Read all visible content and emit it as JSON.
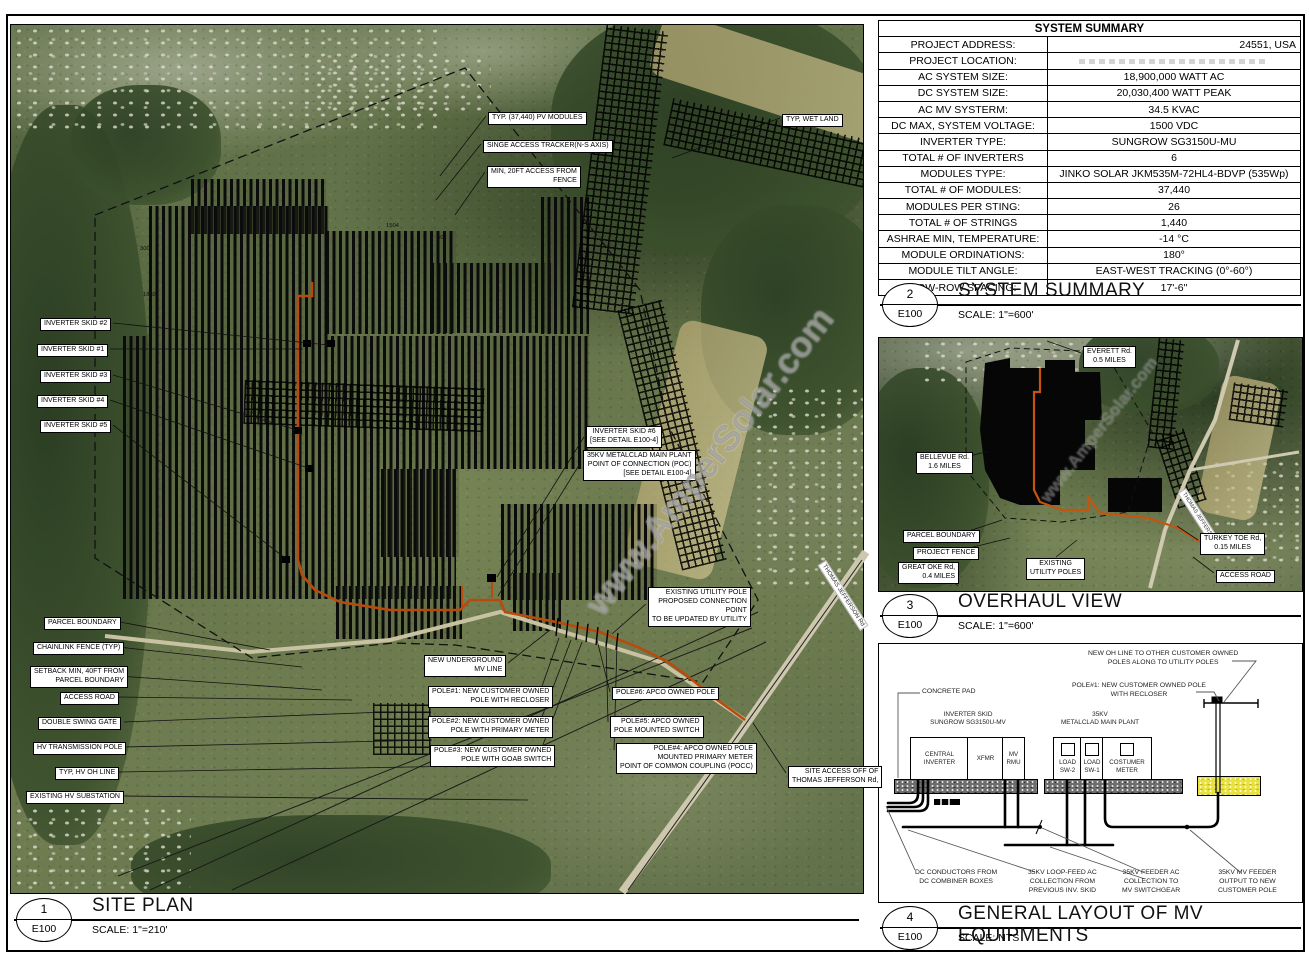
{
  "drawing": {
    "watermark": "www.AmperSolar.com",
    "sheet": "E100"
  },
  "system_summary": {
    "title": "SYSTEM SUMMARY",
    "rows": [
      {
        "label": "PROJECT ADDRESS:",
        "value": "24551, USA"
      },
      {
        "label": "PROJECT LOCATION:",
        "value": ""
      },
      {
        "label": "AC SYSTEM SIZE:",
        "value": "18,900,000 WATT AC"
      },
      {
        "label": "DC SYSTEM SIZE:",
        "value": "20,030,400 WATT PEAK"
      },
      {
        "label": "AC MV SYSTERM:",
        "value": "34.5 KVAC"
      },
      {
        "label": "DC MAX, SYSTEM VOLTAGE:",
        "value": "1500 VDC"
      },
      {
        "label": "INVERTER TYPE:",
        "value": "SUNGROW SG3150U-MU"
      },
      {
        "label": "TOTAL # OF INVERTERS",
        "value": "6"
      },
      {
        "label": "MODULES TYPE:",
        "value": "JINKO SOLAR JKM535M-72HL4-BDVP (535Wp)"
      },
      {
        "label": "TOTAL # OF MODULES:",
        "value": "37,440"
      },
      {
        "label": "MODULES PER STING:",
        "value": "26"
      },
      {
        "label": "TOTAL # OF STRINGS",
        "value": "1,440"
      },
      {
        "label": "ASHRAE MIN, TEMPERATURE:",
        "value": "-14 °C"
      },
      {
        "label": "MODULE ORDINATIONS:",
        "value": "180°"
      },
      {
        "label": "MODULE TILT ANGLE:",
        "value": "EAST-WEST TRACKING (0°-60°)"
      },
      {
        "label": "ROW-ROW SPACING:",
        "value": "17'-6\""
      }
    ]
  },
  "sections": {
    "s1": {
      "num": "1",
      "sheet": "E100",
      "title": "SITE PLAN",
      "scale": "SCALE:   1\"=210'"
    },
    "s2": {
      "num": "2",
      "sheet": "E100",
      "title": "SYSTEM SUMMARY",
      "scale": "SCALE:   1\"=600'"
    },
    "s3": {
      "num": "3",
      "sheet": "E100",
      "title": "OVERHAUL VIEW",
      "scale": "SCALE:   1\"=600'"
    },
    "s4": {
      "num": "4",
      "sheet": "E100",
      "title": "GENERAL LAYOUT OF MV EQUIPMENTS",
      "scale": "SCALE:  NTS"
    }
  },
  "site_plan": {
    "road_label": "THOMAS JEFFERSON Rd",
    "dimensions": [
      {
        "id": "d1",
        "text": "300"
      },
      {
        "id": "d2",
        "text": "1504"
      },
      {
        "id": "d3",
        "text": "302"
      },
      {
        "id": "d4",
        "text": "1802"
      }
    ],
    "callouts": [
      {
        "id": "pv-modules",
        "text": "TYP. (37,440) PV MODULES"
      },
      {
        "id": "tracker",
        "text": "SINGE ACCESS TRACKER(N-S AXIS)"
      },
      {
        "id": "fence-access",
        "text": "MIN, 20FT ACCESS FROM\nFENCE"
      },
      {
        "id": "wetland",
        "text": "TYP, WET LAND"
      },
      {
        "id": "skid2",
        "text": "INVERTER SKID #2"
      },
      {
        "id": "skid1",
        "text": "INVERTER SKID #1"
      },
      {
        "id": "skid3",
        "text": "INVERTER SKID #3"
      },
      {
        "id": "skid4",
        "text": "INVERTER SKID #4"
      },
      {
        "id": "skid5",
        "text": "INVERTER SKID #5"
      },
      {
        "id": "skid6",
        "text": "INVERTER SKID #6\n[SEE DETAIL E100-4]"
      },
      {
        "id": "poc",
        "text": "35KV METALCLAD MAIN PLANT\nPOINT OF CONNECTION (POC)\n[SEE DETAIL E100-4]"
      },
      {
        "id": "parcel-boundary",
        "text": "PARCEL BOUNDARY"
      },
      {
        "id": "chainlink",
        "text": "CHAINLINK FENCE (TYP)"
      },
      {
        "id": "setback",
        "text": "SETBACK MIN, 40FT FROM\nPARCEL BOUNDARY"
      },
      {
        "id": "access-road",
        "text": "ACCESS ROAD"
      },
      {
        "id": "swing-gate",
        "text": "DOUBLE SWING GATE"
      },
      {
        "id": "hv-pole",
        "text": "HV TRANSMISSION POLE"
      },
      {
        "id": "hv-oh-line",
        "text": "TYP, HV OH LINE"
      },
      {
        "id": "hv-substation",
        "text": "EXISTING HV SUBSTATION"
      },
      {
        "id": "new-mv-line",
        "text": "NEW UNDERGROUND\nMV LINE"
      },
      {
        "id": "pole1",
        "text": "POLE#1: NEW CUSTOMER OWNED\nPOLE WITH RECLOSER"
      },
      {
        "id": "pole2",
        "text": "POLE#2: NEW CUSTOMER OWNED\nPOLE WITH PRIMARY METER"
      },
      {
        "id": "pole3",
        "text": "POLE#3: NEW CUSTOMER OWNED\nPOLE WITH GOAB SWITCH"
      },
      {
        "id": "pole6",
        "text": "POLE#6: APCO OWNED POLE"
      },
      {
        "id": "pole5",
        "text": "POLE#5: APCO OWNED\nPOLE MOUNTED SWITCH"
      },
      {
        "id": "pole4",
        "text": "POLE#4: APCO OWNED POLE\nMOUNTED PRIMARY METER\nPOINT OF COMMON COUPLING (POCC)"
      },
      {
        "id": "existing-utility-pole",
        "text": "EXISTING UTILITY POLE\nPROPOSED CONNECTION\nPOINT\nTO BE UPDATED BY UTILITY"
      },
      {
        "id": "site-access",
        "text": "SITE ACCESS OFF OF\nTHOMAS JEFFERSON Rd,"
      }
    ]
  },
  "overhaul_view": {
    "road_label": "THOMAS JEFFERSON Rd",
    "callouts": [
      {
        "id": "everett",
        "text": "EVERETT Rd.\n0.5 MILES"
      },
      {
        "id": "bellevue",
        "text": "BELLEVUE Rd.\n1.6 MILES"
      },
      {
        "id": "parcel-boundary-ov",
        "text": "PARCEL BOUNDARY"
      },
      {
        "id": "project-fence",
        "text": "PROJECT FENCE"
      },
      {
        "id": "great-oke",
        "text": "GREAT OKE Rd,\n0.4 MILES"
      },
      {
        "id": "existing-utility-poles-ov",
        "text": "EXISTING\nUTILITY POLES"
      },
      {
        "id": "turkey-toe",
        "text": "TURKEY TOE Rd,\n0.15 MILES"
      },
      {
        "id": "access-road-ov",
        "text": "ACCESS ROAD"
      }
    ]
  },
  "mv_layout": {
    "group_labels": [
      {
        "id": "inverter-skid-group",
        "text": "INVERTER SKID\nSUNGROW SG3150U-MV"
      },
      {
        "id": "metalclad-group",
        "text": "35KV\nMETALCLAD MAIN PLANT"
      }
    ],
    "boxes": [
      {
        "id": "central-inverter",
        "label": "CENTRAL\nINVERTER",
        "square": false
      },
      {
        "id": "xfmr",
        "label": "XFMR",
        "square": false
      },
      {
        "id": "mv-rmu",
        "label": "MV\nRMU",
        "square": false
      },
      {
        "id": "load-sw2",
        "label": "LOAD\nSW-2",
        "square": true
      },
      {
        "id": "load-sw1",
        "label": "LOAD\nSW-1",
        "square": true
      },
      {
        "id": "costumer-meter",
        "label": "COSTUMER\nMETER",
        "square": true
      }
    ],
    "callouts": [
      {
        "id": "concrete-pad",
        "text": "CONCRETE PAD"
      },
      {
        "id": "oh-line",
        "text": "NEW OH LINE TO OTHER CUSTOMER OWNED\nPOLES ALONG TO UTILITY POLES"
      },
      {
        "id": "pole1-recloser",
        "text": "POLE#1: NEW CUSTOMER OWNED POLE\nWITH RECLOSER"
      },
      {
        "id": "dc-conductors",
        "text": "DC CONDUCTORS FROM\nDC COMBINER BOXES"
      },
      {
        "id": "loop-feed",
        "text": "35KV LOOP-FEED AC\nCOLLECTION FROM\nPREVIOUS INV. SKID"
      },
      {
        "id": "feeder-ac",
        "text": "35KV FEEDER AC\nCOLLECTION TO\nMV SWITCHGEAR"
      },
      {
        "id": "mv-feeder",
        "text": "35KV MV FEEDER\nOUTPUT TO NEW\nCUSTOMER POLE"
      }
    ]
  }
}
